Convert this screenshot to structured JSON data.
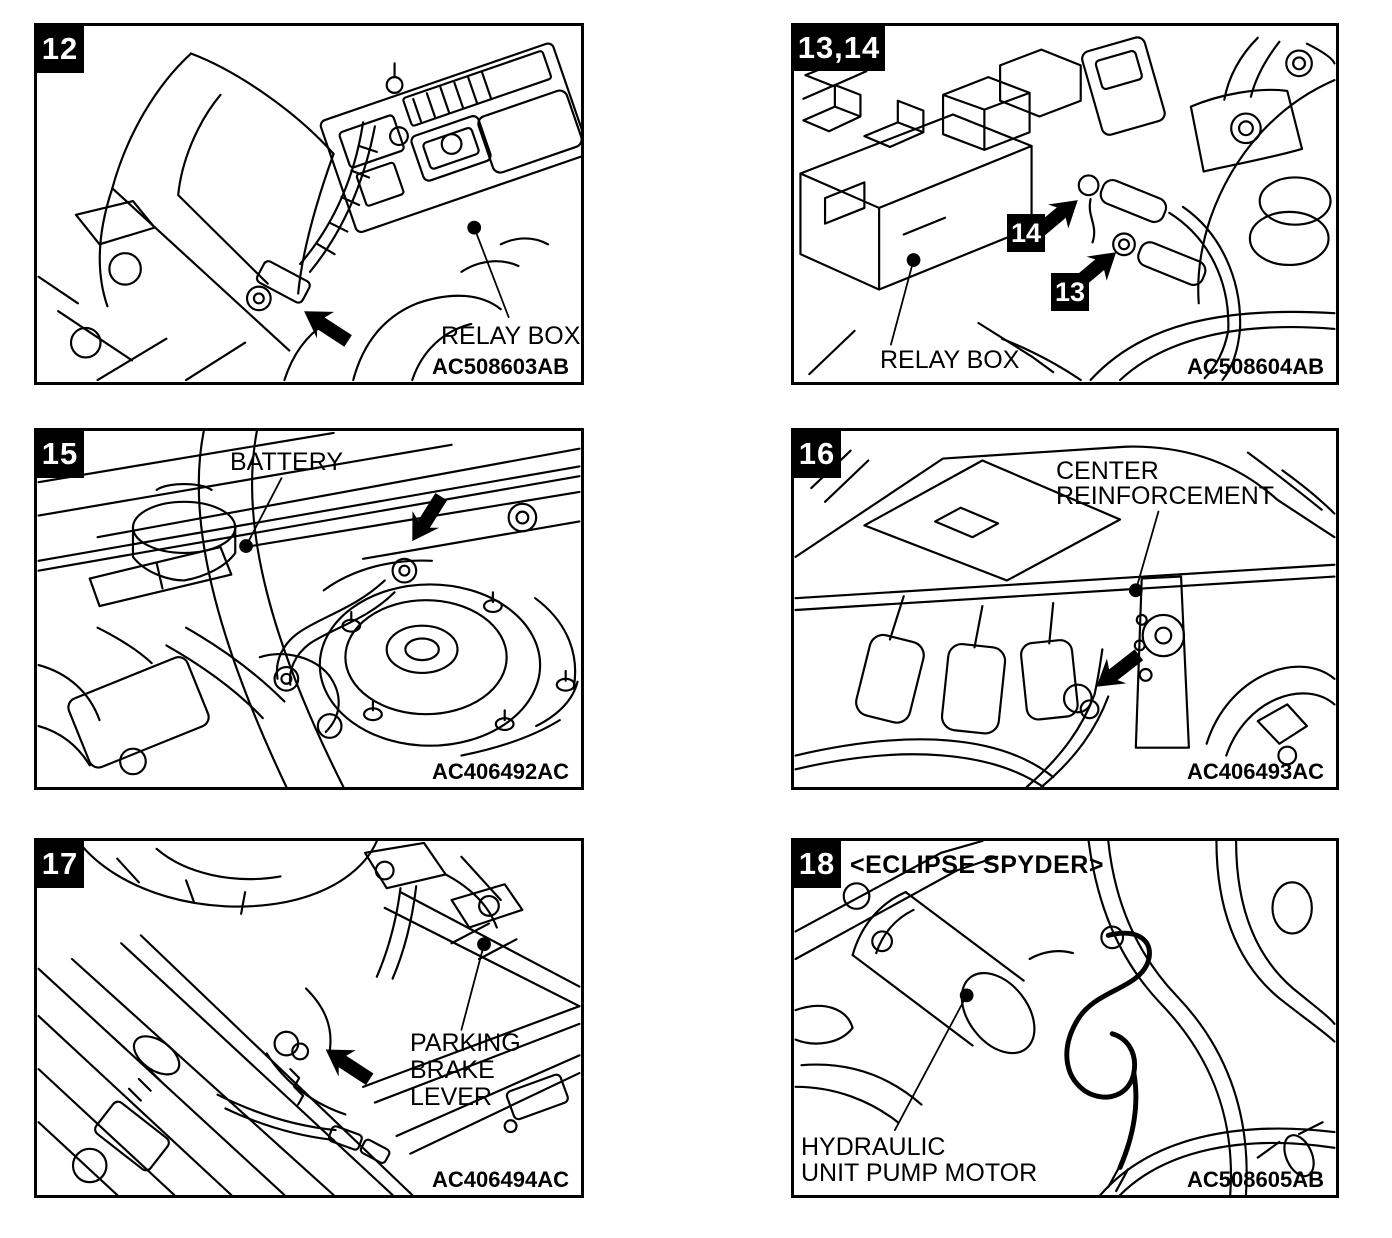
{
  "page": {
    "paper_color": "#ffffff",
    "ink_color": "#000000"
  },
  "panels": [
    {
      "badge": "12",
      "callout": "RELAY BOX",
      "code": "AC508603AB"
    },
    {
      "badge": "13,14",
      "inner_badges": [
        "14",
        "13"
      ],
      "callout": "RELAY BOX",
      "code": "AC508604AB"
    },
    {
      "badge": "15",
      "callout": "BATTERY",
      "code": "AC406492AC"
    },
    {
      "badge": "16",
      "callout": "CENTER\nREINFORCEMENT",
      "code": "AC406493AC"
    },
    {
      "badge": "17",
      "callout": "PARKING\nBRAKE\nLEVER",
      "code": "AC406494AC"
    },
    {
      "badge": "18",
      "variant_note": "<ECLIPSE SPYDER>",
      "callout": "HYDRAULIC\nUNIT PUMP MOTOR",
      "code": "AC508605AB"
    }
  ]
}
